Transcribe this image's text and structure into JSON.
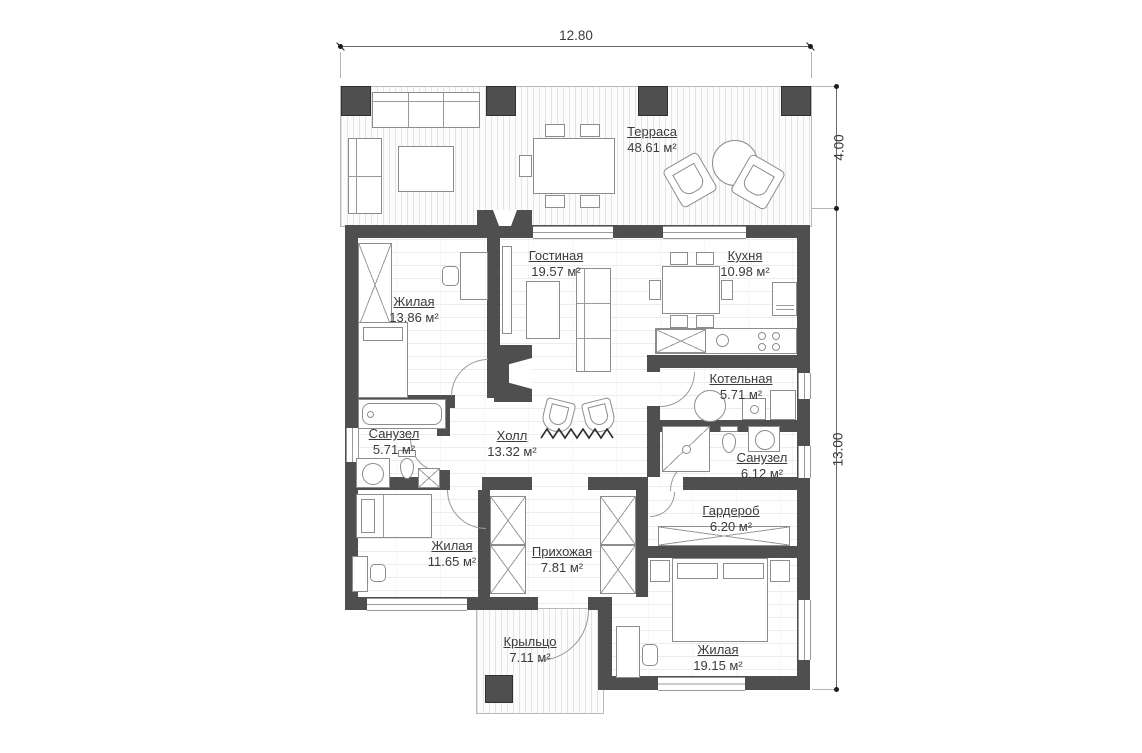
{
  "plan": {
    "dimensions": {
      "width": "12.80",
      "terrace_depth": "4.00",
      "house_depth": "13.00"
    },
    "area_unit": "м²",
    "rooms": [
      {
        "name": "Терраса",
        "area": "48.61 м²"
      },
      {
        "name": "Жилая",
        "area": "13.86 м²"
      },
      {
        "name": "Гостиная",
        "area": "19.57 м²"
      },
      {
        "name": "Кухня",
        "area": "10.98 м²"
      },
      {
        "name": "Санузел",
        "area": "5.71 м²"
      },
      {
        "name": "Холл",
        "area": "13.32 м²"
      },
      {
        "name": "Котельная",
        "area": "5.71 м²"
      },
      {
        "name": "Санузел",
        "area": "6.12 м²"
      },
      {
        "name": "Жилая",
        "area": "11.65 м²"
      },
      {
        "name": "Прихожая",
        "area": "7.81 м²"
      },
      {
        "name": "Гардероб",
        "area": "6.20 м²"
      },
      {
        "name": "Жилая",
        "area": "19.15 м²"
      },
      {
        "name": "Крыльцо",
        "area": "7.11 м²"
      }
    ],
    "colors": {
      "wall": "#4f4f4f",
      "outline": "#8d8d8d",
      "text": "#3b3b3b"
    }
  }
}
